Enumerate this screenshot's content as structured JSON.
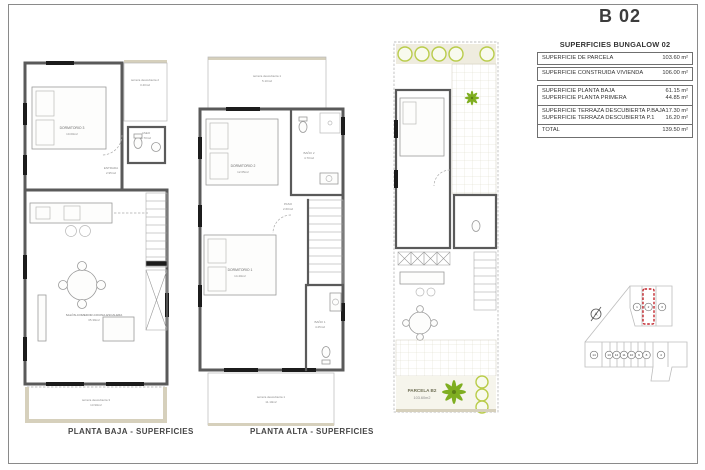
{
  "sheet": {
    "title": "B 02"
  },
  "captions": {
    "baja": "PLANTA BAJA - SUPERFICIES",
    "alta": "PLANTA ALTA - SUPERFICIES"
  },
  "table": {
    "title": "SUPERFICIES BUNGALOW 02",
    "rows": [
      {
        "label": "SUPERFICIE DE PARCELA",
        "value": "103.60 m²"
      },
      {
        "label": "SUPERFICIE CONSTRUIDA VIVIENDA",
        "value": "106.00 m²"
      },
      {
        "label": "SUPERFICIE PLANTA BAJA",
        "value": "61.15 m²"
      },
      {
        "label": "SUPERFICIE PLANTA PRIMERA",
        "value": "44.85 m²"
      },
      {
        "label": "SUPERFICIE TERRAZA DESCUBIERTA P.BAJA",
        "value": "17.30 m²"
      },
      {
        "label": "SUPERFICIE TERRAZA DESCUBIERTA P.1",
        "value": "16.20 m²"
      },
      {
        "label": "TOTAL",
        "value": "139.50 m²"
      }
    ]
  },
  "plans": {
    "baja": {
      "rooms": [
        {
          "name": "terraza descubierta 2",
          "area": "3.40m2"
        },
        {
          "name": "DORMITORIO 3",
          "area": "10.00m2"
        },
        {
          "name": "ENTRADA",
          "area": "2.95m2"
        },
        {
          "name": "ASEO",
          "area": "1.70m2"
        },
        {
          "name": "SALÓN-COMEDOR-COCINA-ESCALERA",
          "area": "35.39m2"
        },
        {
          "name": "terraza descubierta 3",
          "area": "13.90m2"
        }
      ]
    },
    "alta": {
      "rooms": [
        {
          "name": "terraza descubierta 1",
          "area": "5.10m2"
        },
        {
          "name": "DORMITORIO 2",
          "area": "12.65m2"
        },
        {
          "name": "BAÑO 2",
          "area": "4.70m2"
        },
        {
          "name": "PASO",
          "area": "2.60m2"
        },
        {
          "name": "DORMITORIO 1",
          "area": "14.40m2"
        },
        {
          "name": "BAÑO 1",
          "area": "4.25m2"
        },
        {
          "name": "terraza descubierta 1",
          "area": "11.10m2"
        }
      ]
    },
    "parcela": {
      "label": "PARCELA B2",
      "area": "103.60m2"
    }
  },
  "site_map": {
    "compass": "A",
    "lots_top": [
      "1",
      "2",
      "3"
    ],
    "lots_bottom": [
      "14",
      "13",
      "12",
      "11",
      "10",
      "9",
      "8",
      "4"
    ]
  },
  "colors": {
    "wall_gray": "#5a5a5a",
    "beige": "#d6d0bc",
    "bush_green": "#b9cc4a",
    "palm_green": "#7fae21",
    "highlight_red": "#c4272e"
  }
}
